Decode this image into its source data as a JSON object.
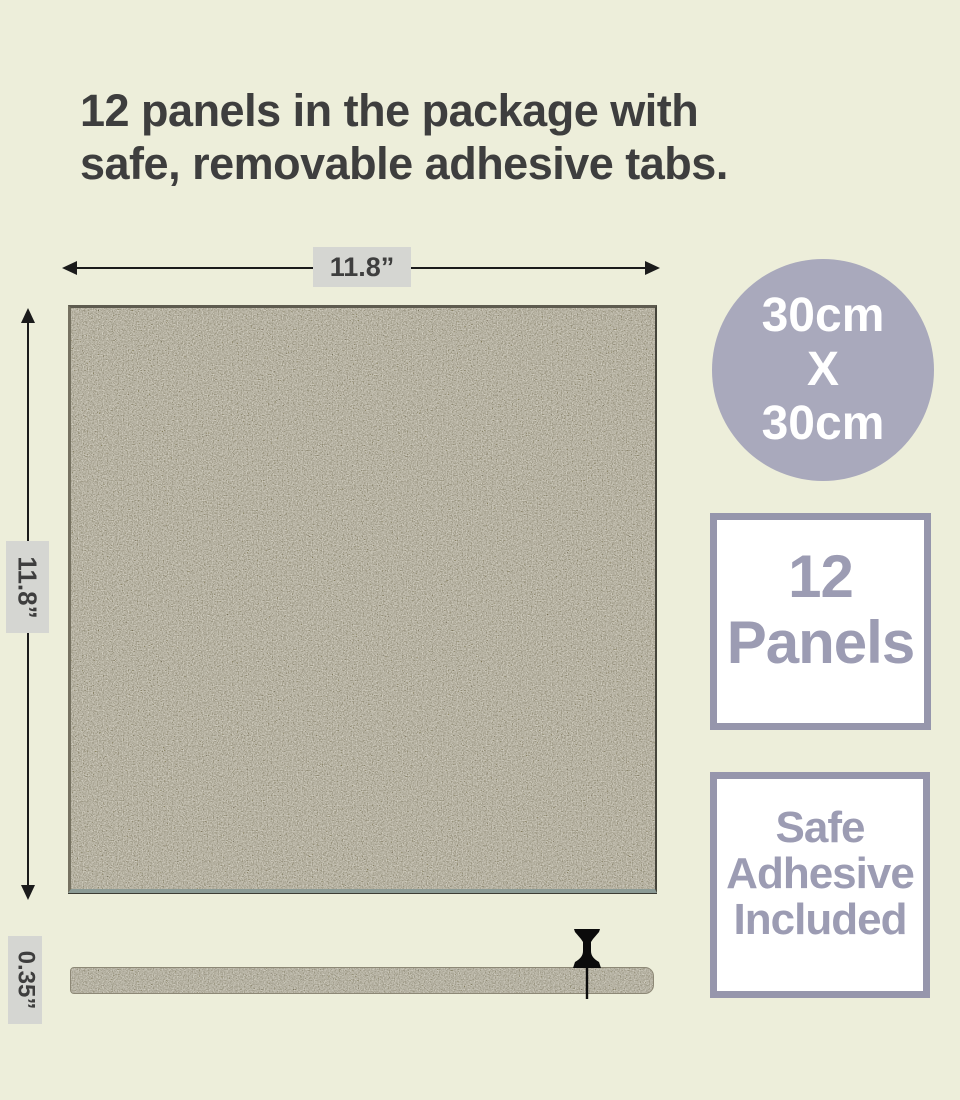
{
  "title": {
    "line1": "12 panels in the package with",
    "line2": "safe, removable adhesive tabs."
  },
  "dimensions": {
    "width": "11.8”",
    "height": "11.8”",
    "thickness": "0.35”"
  },
  "badges": {
    "size_circle": {
      "line1": "30cm",
      "line2": "X",
      "line3": "30cm"
    },
    "panel_count": {
      "line1": "12",
      "line2": "Panels"
    },
    "adhesive": {
      "line1": "Safe",
      "line2": "Adhesive",
      "line3": "Included"
    }
  },
  "icons": {
    "pushpin": "black pushpin pinned through panel side view"
  },
  "colors": {
    "background": "#edeeda",
    "title_text": "#3e3e3e",
    "accent_lavender": "#a9a9bc",
    "badge_border": "#9696ac",
    "badge_text": "#9c9cb3",
    "badge_fill": "#ffffff",
    "dim_label_bg": "#d5d6d2",
    "dim_label_text": "#3e3e3e",
    "arrow": "#1b1b1b",
    "felt_base": "#9c9682",
    "pushpin": "#0b0b0b"
  }
}
